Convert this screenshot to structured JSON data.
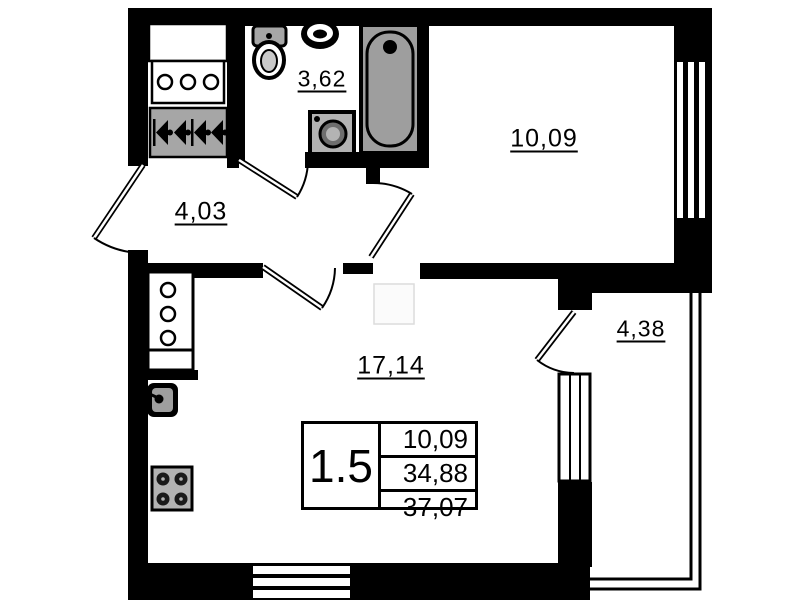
{
  "rooms": {
    "bathroom": {
      "label": "3,62"
    },
    "bedroom": {
      "label": "10,09"
    },
    "hallway": {
      "label": "4,03"
    },
    "living_room": {
      "label": "17,14"
    },
    "balcony": {
      "label": "4,38"
    }
  },
  "info_table": {
    "rooms_count": "1.5",
    "row1": "10,09",
    "row2": "34,88",
    "row3": "37,07"
  },
  "colors": {
    "wall": "#000000",
    "background": "#ffffff",
    "fixture_gray": "#a6a6a6"
  }
}
